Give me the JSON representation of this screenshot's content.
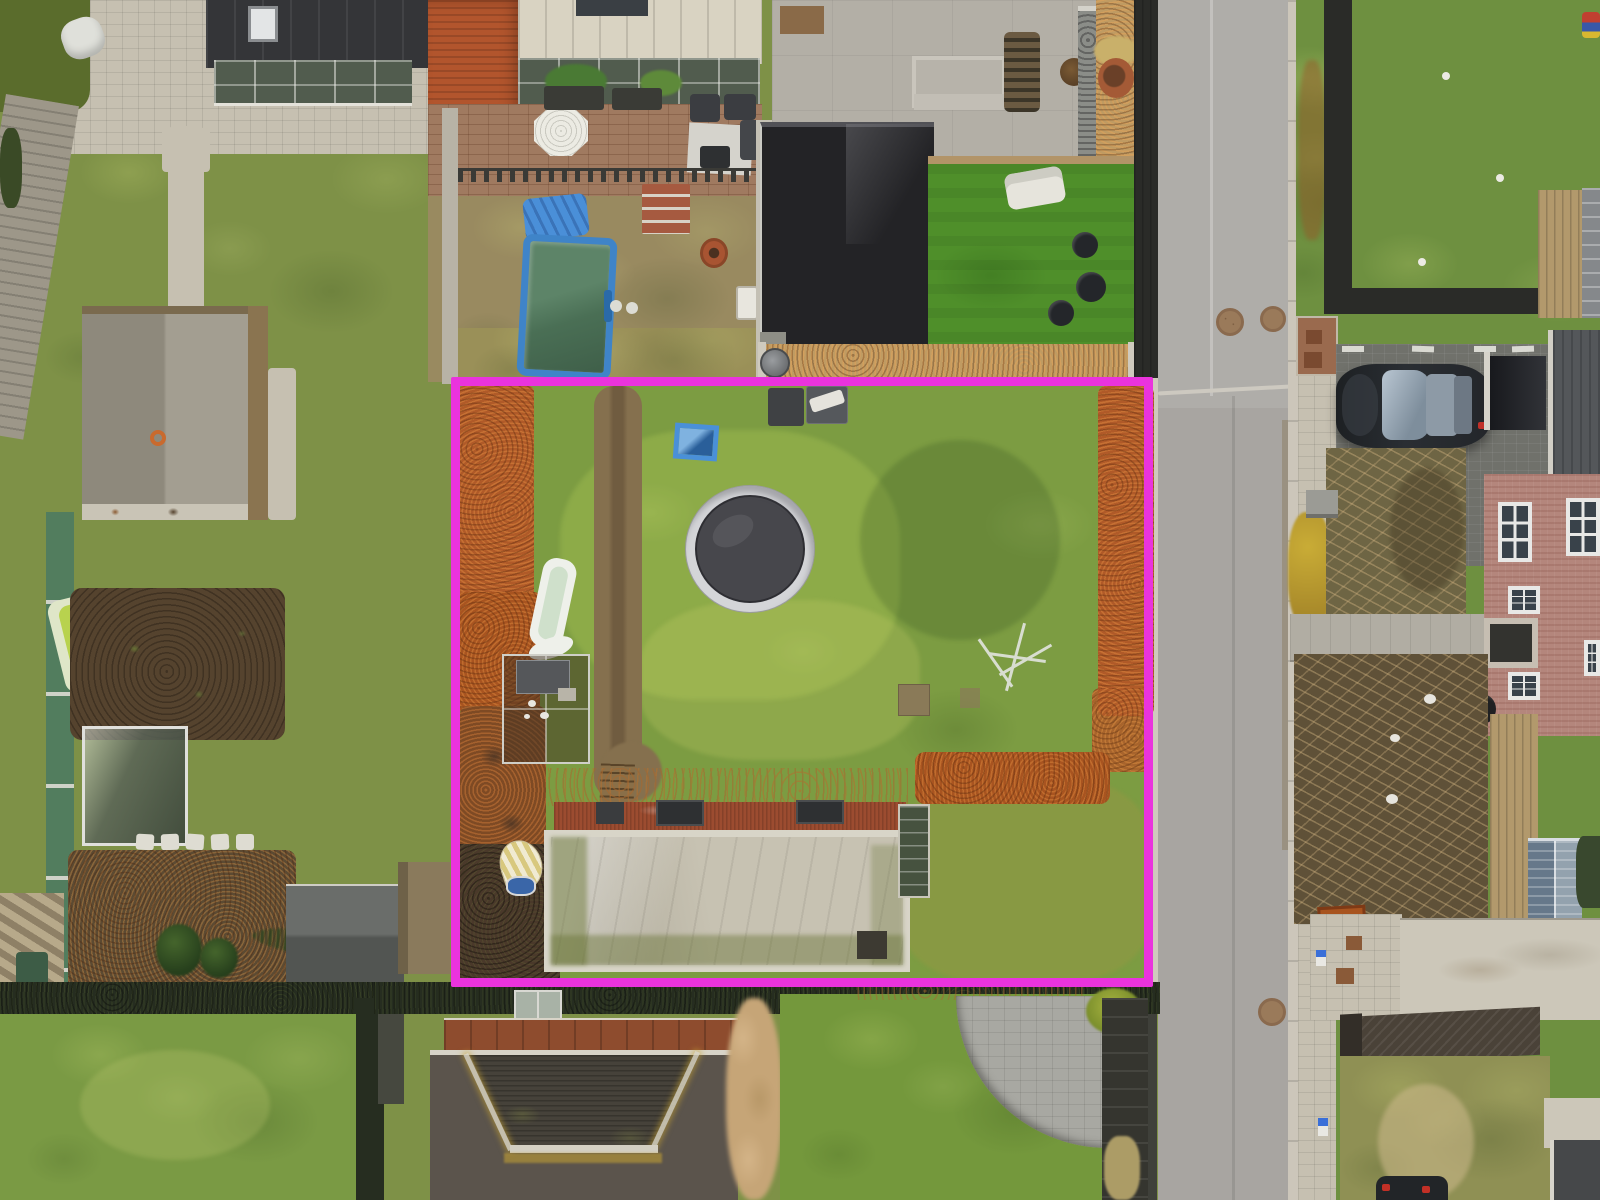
{
  "scene": {
    "type": "aerial-drone-photo",
    "description": "Top-down aerial photograph of suburban back gardens. A vacant grass building plot between neighbouring houses is outlined with a bright magenta rectangle. The plot contains a trampoline, a small blue sandbox, a white slide, a mesh chicken coop, a long outbuilding with a pale weathered roof, beech hedges turned orange, and a worn dirt path. A gray road with manholes, sidewalks, a parked dark car, a paved driveway and a pink-brick house occupy the right side.",
    "plot_outline": {
      "shape": "rectangle",
      "color": "#ea33dd"
    },
    "landmarks": [
      "trampoline",
      "blue-sandbox",
      "children-slide",
      "chicken-coop",
      "long-outbuilding",
      "orange-beech-hedges",
      "dirt-path",
      "above-ground-pool",
      "blue-tarp",
      "flat-roof-extension",
      "artificial-lawn",
      "concrete-patio",
      "brick-patio",
      "greenhouse",
      "garden-sheds",
      "vegetable-patch",
      "road",
      "sidewalk",
      "manhole-covers",
      "parked-car",
      "driveway",
      "brick-house",
      "hip-roof-house",
      "stone-patio-curved",
      "pampas-grass",
      "yellow-shrub",
      "wooden-fences"
    ]
  },
  "palette": {
    "magenta": "#ea33dd",
    "road": "#a8a5a1",
    "curb": "#ccc6ba",
    "sidewalk": "#c6c0b1",
    "grass-left": "#7e9147",
    "grass-plot": "#7c9c42",
    "grass-right": "#6e9040",
    "grass-neon": "#4f8f2a",
    "grass-bottom": "#74983c",
    "hedge-orange": "#b05a28",
    "hedge-dark": "#262d20",
    "dirt-path": "#85704e",
    "soil-dark": "#55432e",
    "mulch": "#c09b62",
    "roof-dark": "#232326",
    "roof-charcoal": "#343538",
    "roof-orange-tile": "#b2552d",
    "roof-cream": "#d9d3c2",
    "patio-concrete": "#b3afa6",
    "patio-brick": "#a07a60",
    "glass-dark": "#515c4e",
    "pool-blue": "#3f84c8",
    "tramp-mat": "#47474c",
    "tramp-ring": "#d4d5d8",
    "outbuilding-roof": "#c7c2b2",
    "outbuilding-trim": "#d8d5c8",
    "outbuilding-brick": "#9c4c30",
    "shed-gray": "#5a5d5b",
    "wood-tan": "#b2996c",
    "fence-green": "#4c7a62",
    "fence-dark": "#2a2b28",
    "house-roof": "#5b544c",
    "house-roof-dark": "#46423a",
    "lichen": "#c9a433",
    "rust-roof": "#8e4c2e",
    "pampas": "#c6a577",
    "brick-house": "#b4867c",
    "driveway": "#70716b",
    "car-body": "#23262a",
    "car-glass": "#b9c6d2",
    "bush-yellow": "#c9ac36",
    "bed-olive": "#6e6544",
    "bed-dark": "#5f5138",
    "stone-patio": "#a8a8a2",
    "concrete-pale": "#ccc7b9",
    "shed-blue": "#7e8d99",
    "corten": "#a8541f",
    "white": "#e9e8e3"
  }
}
